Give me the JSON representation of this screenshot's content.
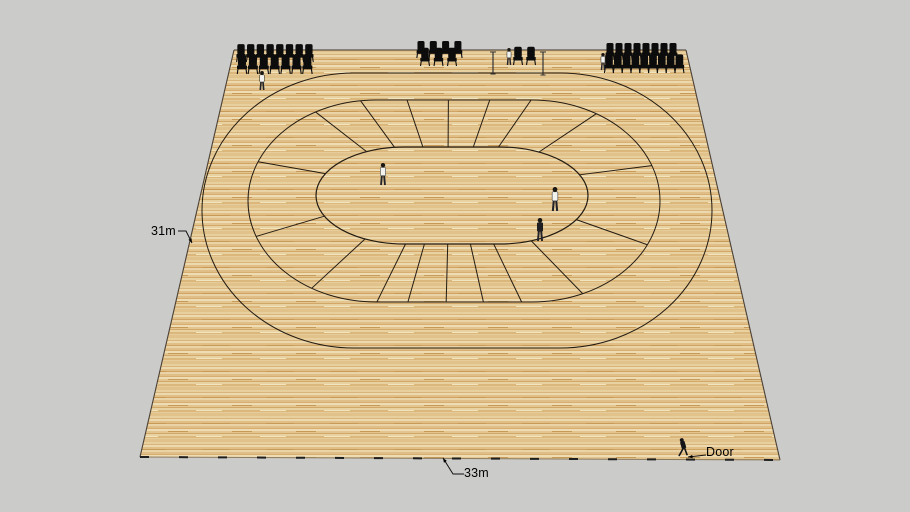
{
  "labels": {
    "left_dimension": "31m",
    "bottom_dimension": "33m",
    "door": "Door"
  },
  "colors": {
    "background": "#cbcbca",
    "wood_base": "#e3c38d",
    "wood_light": "#eedcb4",
    "wood_dark": "#cfa465",
    "line": "#241c12",
    "edge": "#4a4035",
    "chair": "#0c0c0c",
    "label_text": "#000000",
    "shirt_light": "#f2f2ee",
    "shirt_dark": "#202024"
  },
  "scene": {
    "floor": {
      "corners": [
        [
          234,
          50
        ],
        [
          686,
          50
        ],
        [
          780,
          460
        ],
        [
          140,
          457
        ]
      ],
      "bottom_dash": [
        9,
        30
      ]
    },
    "track": {
      "outer": {
        "L": 202,
        "R": 712,
        "T": 73,
        "B": 348,
        "rx": 152
      },
      "middle": {
        "L": 248,
        "R": 660,
        "T": 100,
        "B": 302,
        "rx": 128
      },
      "inner": {
        "L": 316,
        "R": 588,
        "T": 147,
        "B": 244,
        "rx": 88
      },
      "spoke_fractions": [
        0.03,
        0.07,
        0.11,
        0.15,
        0.215,
        0.29,
        0.37,
        0.45,
        0.51,
        0.547,
        0.583,
        0.62,
        0.65,
        0.715,
        0.79,
        0.865,
        0.94,
        0.985
      ]
    },
    "people": [
      {
        "x": 383,
        "y": 185,
        "h": 22,
        "style": "light"
      },
      {
        "x": 555,
        "y": 211,
        "h": 24,
        "style": "light"
      },
      {
        "x": 540,
        "y": 241,
        "h": 23,
        "style": "dark"
      },
      {
        "x": 262,
        "y": 90,
        "h": 19,
        "style": "light"
      },
      {
        "x": 509,
        "y": 65,
        "h": 17,
        "style": "light"
      },
      {
        "x": 603,
        "y": 70,
        "h": 17,
        "style": "light"
      },
      {
        "x": 684,
        "y": 456,
        "h": 18,
        "style": "walk"
      }
    ],
    "chair_rows": [
      {
        "group": "left",
        "count": 8,
        "x0": 241,
        "dx": 9.7,
        "y": 62,
        "s": 1.15
      },
      {
        "group": "left",
        "count": 7,
        "x0": 242,
        "dx": 10.9,
        "y": 74,
        "s": 1.25
      },
      {
        "group": "middle",
        "count": 4,
        "x0": 421,
        "dx": 12.3,
        "y": 58,
        "s": 1.1
      },
      {
        "group": "middle",
        "count": 3,
        "x0": 425,
        "dx": 13.5,
        "y": 66,
        "s": 1.18
      },
      {
        "group": "pair",
        "count": 2,
        "x0": 518,
        "dx": 13.0,
        "y": 65,
        "s": 1.18
      },
      {
        "group": "right",
        "count": 8,
        "x0": 610,
        "dx": 9.0,
        "y": 60,
        "s": 1.1
      },
      {
        "group": "right",
        "count": 9,
        "x0": 609,
        "dx": 8.8,
        "y": 73,
        "s": 1.2
      }
    ],
    "posts": [
      {
        "x": 493,
        "y1": 52,
        "y2": 74
      },
      {
        "x": 543,
        "y1": 52,
        "y2": 75
      }
    ],
    "leaders": [
      {
        "name": "leader-31m",
        "points": [
          [
            178,
            231
          ],
          [
            186,
            231
          ],
          [
            192,
            243
          ]
        ]
      },
      {
        "name": "leader-33m",
        "points": [
          [
            464,
            474
          ],
          [
            453,
            474
          ],
          [
            443,
            458
          ]
        ]
      },
      {
        "name": "leader-door",
        "points": [
          [
            706,
            455
          ],
          [
            697,
            456
          ],
          [
            688,
            457
          ]
        ]
      }
    ]
  }
}
